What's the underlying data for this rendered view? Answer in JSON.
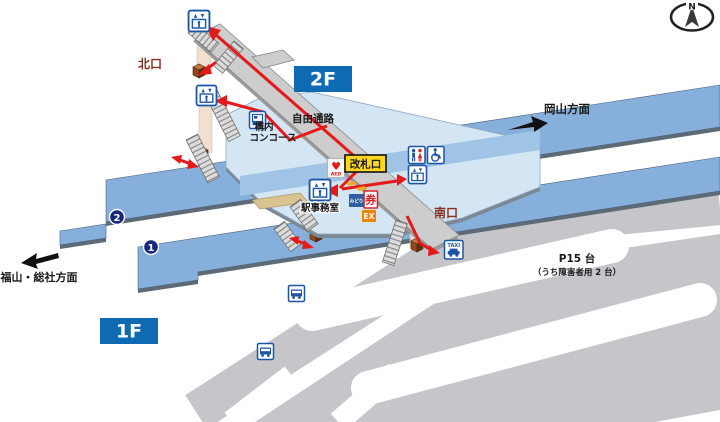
{
  "compass": {
    "label": "N"
  },
  "floors": {
    "f2": "2F",
    "f1": "1F"
  },
  "exits": {
    "north": "北口",
    "south": "南口"
  },
  "directions": {
    "okayama": "岡山方面",
    "fukuyama_soja": "福山・総社方面"
  },
  "labels": {
    "free_passage": "自由通路",
    "concourse_line1": "構内",
    "concourse_line2": "コンコース",
    "ticket_gate": "改札口",
    "station_office": "駅事務室"
  },
  "platforms": {
    "p1": "1",
    "p2": "2"
  },
  "parking": {
    "line1": "P15 台",
    "line2": "（うち障害者用 2 台）"
  },
  "machines": {
    "midori": "みどり",
    "ticket": "券",
    "ex": "EX"
  },
  "facilities": {
    "aed": "AED",
    "taxi": "TAXI"
  },
  "colors": {
    "route_red": "#E61919",
    "platform_blue": "#86AFDC",
    "platform_band_blue": "#9FC4E6",
    "concourse_blue": "#D4E6F4",
    "walkway_gray": "#CDCDCD",
    "ground_gray": "#C6C6CA",
    "floor_badge_blue": "#0F6AB4",
    "exit_text_maroon": "#8A3222",
    "icon_blue": "#1C55A5",
    "female_red": "#D6242A",
    "gate_yellow": "#FFD71C",
    "ex_orange": "#F08300",
    "midori_blue": "#2E5FA3",
    "number_navy": "#17277E",
    "elevator_shaft": "#F0DCCD",
    "elevator_cab_brown": "#8E4A20",
    "office_tan": "#D9C491"
  }
}
